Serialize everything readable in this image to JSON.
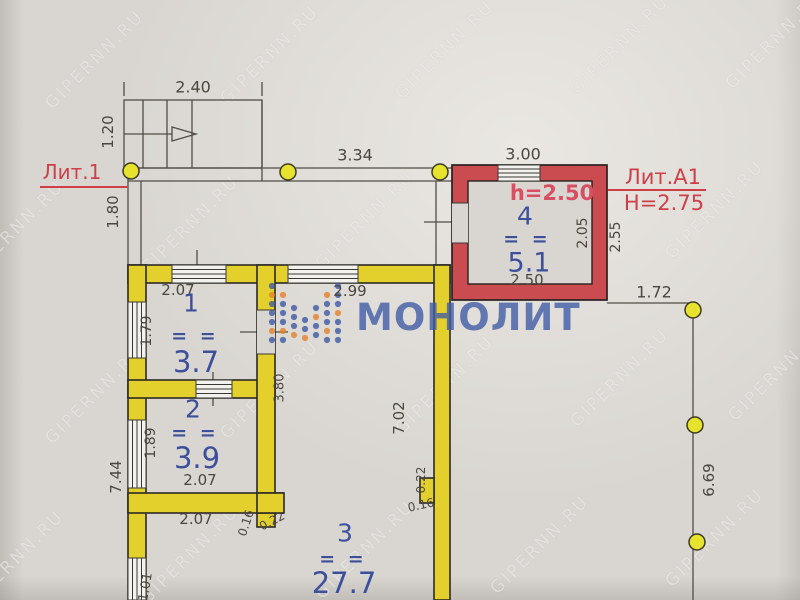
{
  "watermark": {
    "text": "GIPERNN.RU",
    "positions": [
      {
        "x": 95,
        "y": 60
      },
      {
        "x": 270,
        "y": 55
      },
      {
        "x": 445,
        "y": 50
      },
      {
        "x": 620,
        "y": 45
      },
      {
        "x": 775,
        "y": 40
      },
      {
        "x": 15,
        "y": 230
      },
      {
        "x": 190,
        "y": 225
      },
      {
        "x": 365,
        "y": 220
      },
      {
        "x": 540,
        "y": 215
      },
      {
        "x": 715,
        "y": 210
      },
      {
        "x": 95,
        "y": 395
      },
      {
        "x": 270,
        "y": 390
      },
      {
        "x": 445,
        "y": 385
      },
      {
        "x": 620,
        "y": 378
      },
      {
        "x": 778,
        "y": 372
      },
      {
        "x": 15,
        "y": 560
      },
      {
        "x": 190,
        "y": 555
      },
      {
        "x": 365,
        "y": 550
      },
      {
        "x": 540,
        "y": 545
      },
      {
        "x": 715,
        "y": 538
      }
    ]
  },
  "logo": {
    "text": "МОНОЛИТ"
  },
  "annotations": {
    "lit1": "Лит.1",
    "litA1": "Лит.А1",
    "building_height": "H=2.75"
  },
  "rooms": [
    {
      "num": "1",
      "eq": "= =",
      "area": "3.7"
    },
    {
      "num": "2",
      "eq": "= =",
      "area": "3.9"
    },
    {
      "num": "3",
      "eq": "= =",
      "area": "27.7"
    },
    {
      "num": "4",
      "eq": "= =",
      "area": "5.1",
      "ceiling": "h=2.50"
    }
  ],
  "dimensions": [
    {
      "t": "2.40",
      "x": 193,
      "y": 87,
      "r": 0,
      "s": 16
    },
    {
      "t": "1.20",
      "x": 108,
      "y": 132,
      "r": -90,
      "s": 15
    },
    {
      "t": "3.34",
      "x": 355,
      "y": 155,
      "r": 0,
      "s": 16
    },
    {
      "t": "3.00",
      "x": 523,
      "y": 154,
      "r": 0,
      "s": 16
    },
    {
      "t": "1.80",
      "x": 113,
      "y": 212,
      "r": -90,
      "s": 15
    },
    {
      "t": "2.07",
      "x": 178,
      "y": 290,
      "r": 0,
      "s": 15
    },
    {
      "t": "2.99",
      "x": 350,
      "y": 291,
      "r": 0,
      "s": 15
    },
    {
      "t": "1.72",
      "x": 654,
      "y": 292,
      "r": 0,
      "s": 16
    },
    {
      "t": "2.05",
      "x": 583,
      "y": 233,
      "r": -90,
      "s": 14
    },
    {
      "t": "2.55",
      "x": 616,
      "y": 237,
      "r": -90,
      "s": 14
    },
    {
      "t": "2.50",
      "x": 527,
      "y": 280,
      "r": 0,
      "s": 15
    },
    {
      "t": "1.79",
      "x": 147,
      "y": 331,
      "r": -90,
      "s": 14
    },
    {
      "t": "1.89",
      "x": 151,
      "y": 443,
      "r": -90,
      "s": 14
    },
    {
      "t": "3.80",
      "x": 280,
      "y": 388,
      "r": -90,
      "s": 13
    },
    {
      "t": "7.02",
      "x": 399,
      "y": 418,
      "r": -90,
      "s": 15
    },
    {
      "t": "7.44",
      "x": 116,
      "y": 477,
      "r": -90,
      "s": 15
    },
    {
      "t": "2.07",
      "x": 200,
      "y": 480,
      "r": 0,
      "s": 15
    },
    {
      "t": "2.07",
      "x": 196,
      "y": 519,
      "r": 0,
      "s": 15
    },
    {
      "t": "0.16",
      "x": 246,
      "y": 523,
      "r": -72,
      "s": 12
    },
    {
      "t": "0.22",
      "x": 272,
      "y": 521,
      "r": -28,
      "s": 12
    },
    {
      "t": "0.22",
      "x": 421,
      "y": 480,
      "r": -90,
      "s": 12
    },
    {
      "t": "0.16",
      "x": 421,
      "y": 505,
      "r": -12,
      "s": 12
    },
    {
      "t": "1.01",
      "x": 146,
      "y": 587,
      "r": -80,
      "s": 13
    },
    {
      "t": "6.69",
      "x": 709,
      "y": 480,
      "r": -90,
      "s": 15
    }
  ],
  "colors": {
    "wall_yellow": "#e4d02c",
    "wall_red": "#ca4b50",
    "accent_red": "#cf3f48",
    "pink_red": "#d84f62",
    "label_blue": "#3c4f9c",
    "dim_gray": "#4a463f",
    "logo_blue": "#3e5aa5",
    "logo_orange": "#e2822e",
    "dot_yellow": "#e6e22e",
    "paper": "#d9d6d1"
  }
}
